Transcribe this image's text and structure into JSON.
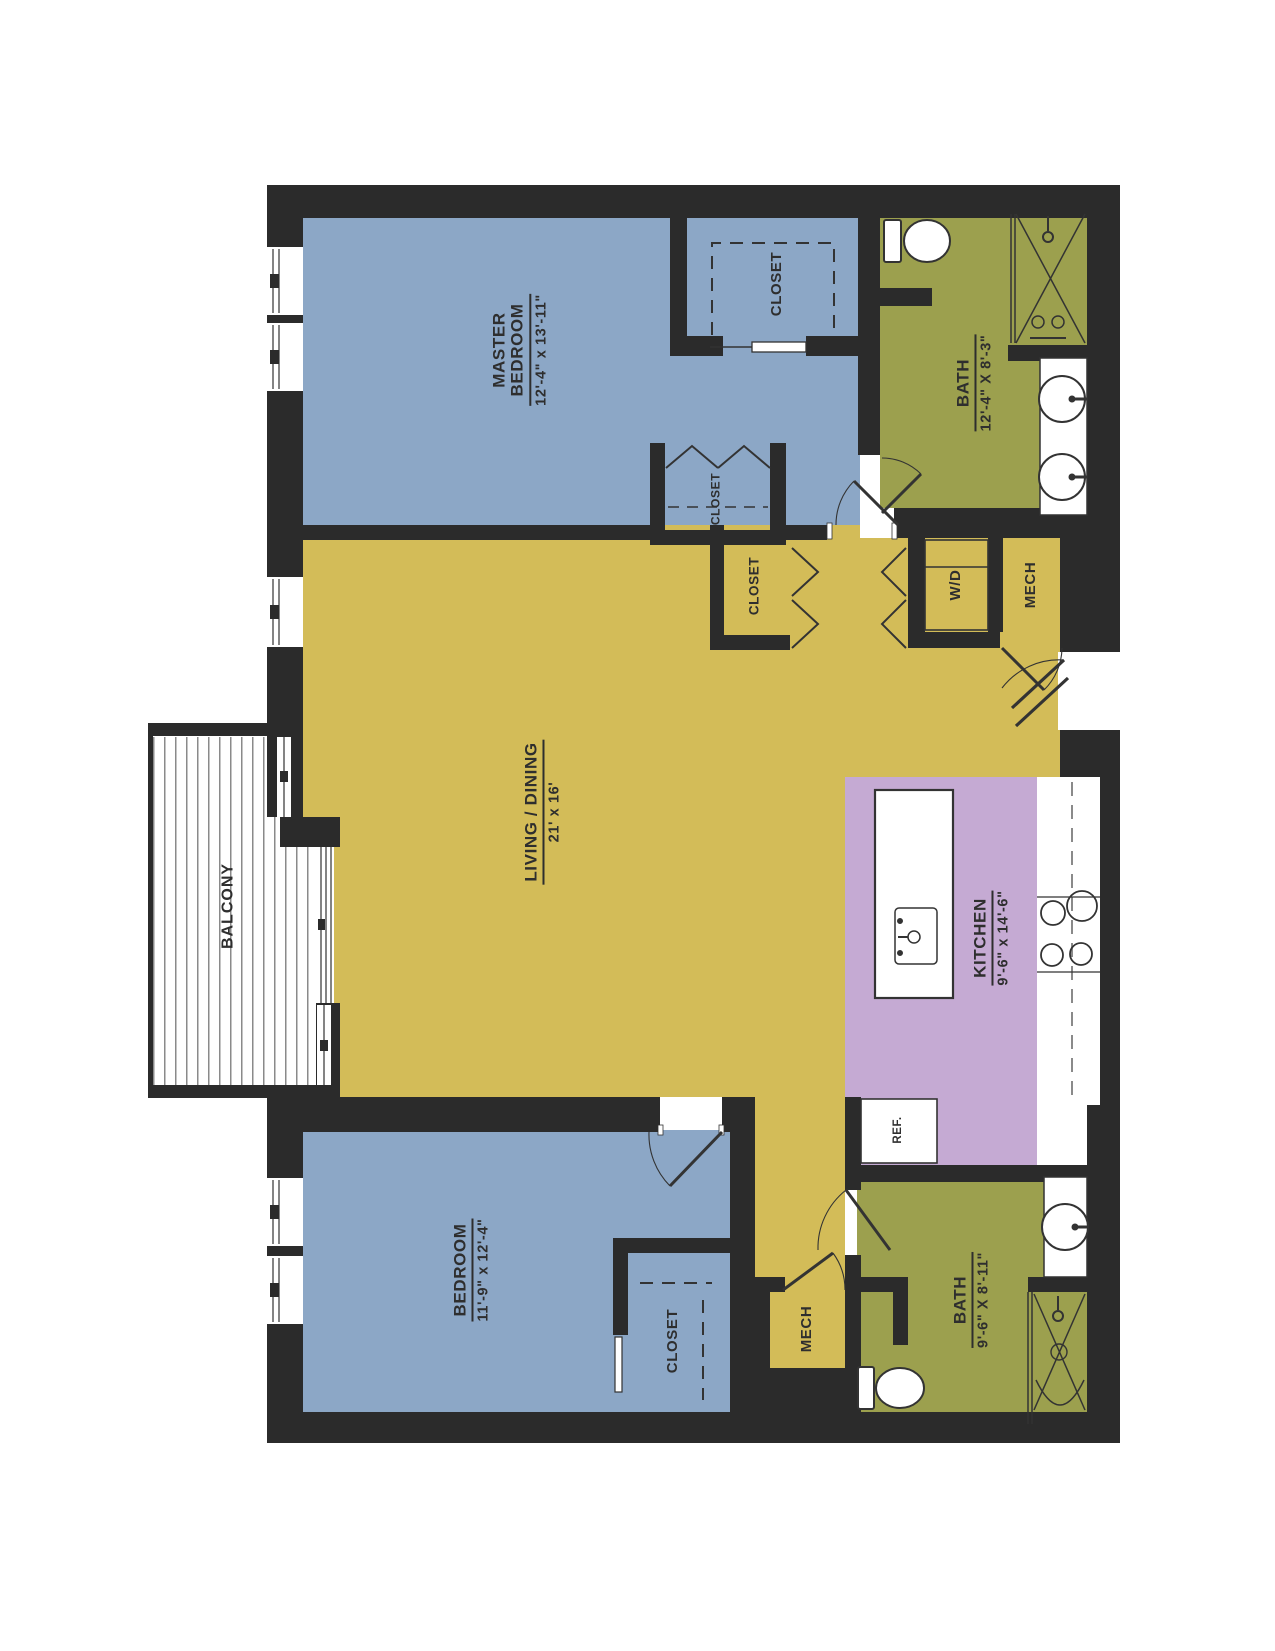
{
  "title": "2 bedroom / 2 bath apartment floor plan",
  "colors": {
    "bedroom_blue": "#8CA7C6",
    "living_yellow": "#D3BC58",
    "bath_green": "#9CA04E",
    "kitchen_purple": "#C5AAD3",
    "wall_black": "#2b2b2b"
  },
  "rooms": {
    "master_bedroom": {
      "line1": "MASTER",
      "line2": "BEDROOM",
      "dims": "12'-4\" x 13'-11\""
    },
    "master_closet": {
      "label": "CLOSET"
    },
    "bath_upper": {
      "line1": "BATH",
      "dims": "12'-4\" X 8'-3\""
    },
    "hall_closet_small": {
      "label": "CLOSET"
    },
    "hall_closet": {
      "label": "CLOSET"
    },
    "washer_dryer": {
      "label": "W/D"
    },
    "mech_upper": {
      "label": "MECH"
    },
    "living_dining": {
      "line1": "LIVING / DINING",
      "dims": "21' x 16'"
    },
    "kitchen": {
      "line1": "KITCHEN",
      "dims": "9'-6\" x 14'-6\""
    },
    "refrigerator": {
      "label": "REF."
    },
    "balcony": {
      "label": "BALCONY"
    },
    "bedroom": {
      "line1": "BEDROOM",
      "dims": "11'-9\" x 12'-4\""
    },
    "bedroom_closet": {
      "label": "CLOSET"
    },
    "mech_lower": {
      "label": "MECH"
    },
    "bath_lower": {
      "line1": "BATH",
      "dims": "9'-6\" X 8'-11\""
    }
  }
}
